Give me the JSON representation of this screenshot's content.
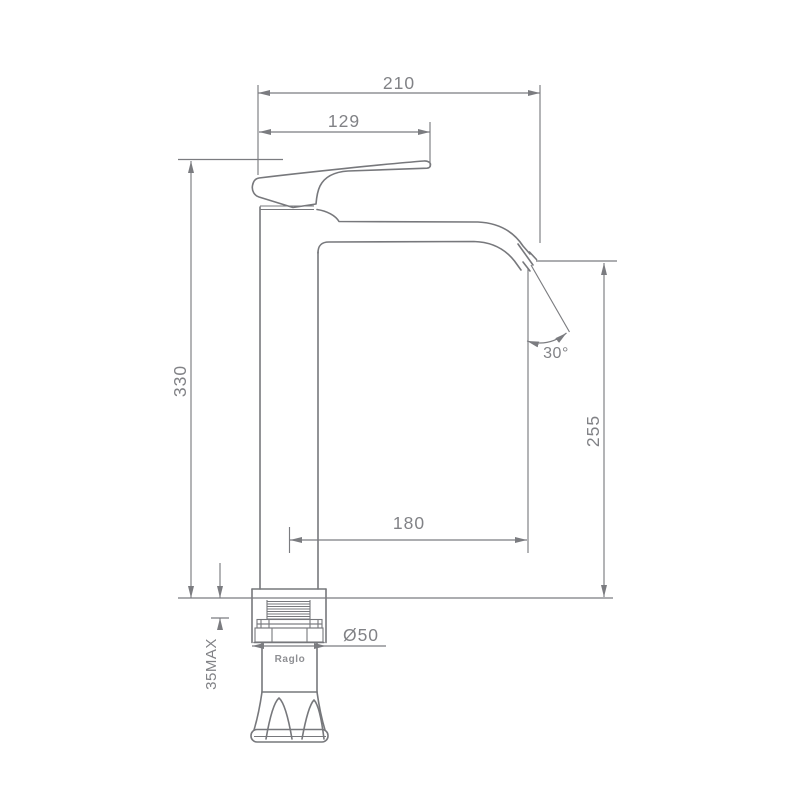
{
  "page": {
    "background_color": "#ffffff"
  },
  "drawing": {
    "brand_label": "Raglo",
    "line_color": "#77787c",
    "dim_text_color": "#818286",
    "dimensions": {
      "top_width": "210",
      "handle_width": "129",
      "total_height": "330",
      "spout_height": "255",
      "spout_reach": "180",
      "spout_angle": "30°",
      "max_mount_thickness": "35MAX",
      "base_diameter": "Ø50"
    }
  }
}
